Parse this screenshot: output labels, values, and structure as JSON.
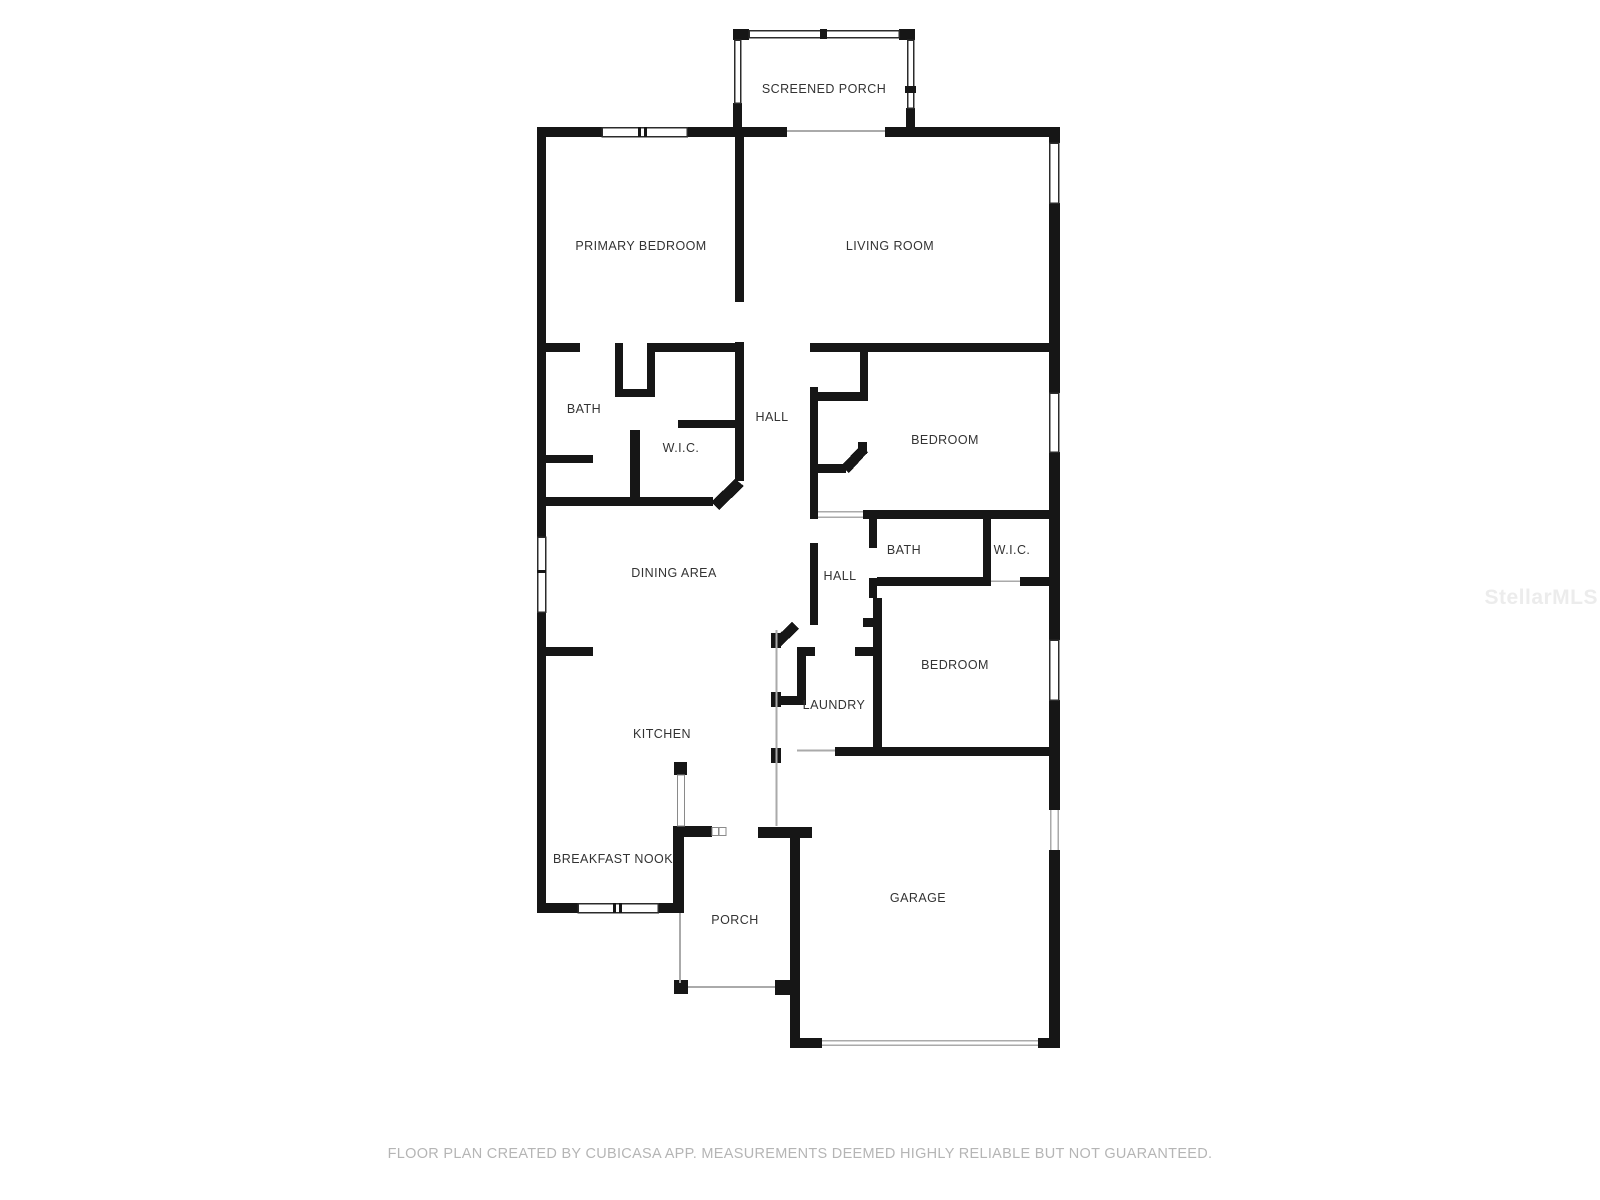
{
  "floor_plan": {
    "rooms": [
      {
        "id": "screened-porch",
        "label": "SCREENED PORCH",
        "x": 824,
        "y": 89
      },
      {
        "id": "primary-bedroom",
        "label": "PRIMARY BEDROOM",
        "x": 641,
        "y": 246
      },
      {
        "id": "living-room",
        "label": "LIVING ROOM",
        "x": 890,
        "y": 246
      },
      {
        "id": "primary-bath",
        "label": "BATH",
        "x": 584,
        "y": 409
      },
      {
        "id": "primary-wic",
        "label": "W.I.C.",
        "x": 681,
        "y": 448
      },
      {
        "id": "hall",
        "label": "HALL",
        "x": 772,
        "y": 417
      },
      {
        "id": "bedroom-2",
        "label": "BEDROOM",
        "x": 945,
        "y": 440
      },
      {
        "id": "dining-area",
        "label": "DINING AREA",
        "x": 674,
        "y": 573
      },
      {
        "id": "hall-2",
        "label": "HALL",
        "x": 840,
        "y": 576
      },
      {
        "id": "bath-2",
        "label": "BATH",
        "x": 904,
        "y": 550
      },
      {
        "id": "wic-2",
        "label": "W.I.C.",
        "x": 1012,
        "y": 550
      },
      {
        "id": "bedroom-3",
        "label": "BEDROOM",
        "x": 955,
        "y": 665
      },
      {
        "id": "laundry",
        "label": "LAUNDRY",
        "x": 834,
        "y": 705
      },
      {
        "id": "kitchen",
        "label": "KITCHEN",
        "x": 662,
        "y": 734
      },
      {
        "id": "breakfast-nook",
        "label": "BREAKFAST NOOK",
        "x": 613,
        "y": 859
      },
      {
        "id": "porch",
        "label": "PORCH",
        "x": 735,
        "y": 920
      },
      {
        "id": "garage",
        "label": "GARAGE",
        "x": 918,
        "y": 898
      }
    ]
  },
  "footer": {
    "text": "FLOOR PLAN CREATED BY CUBICASA APP. MEASUREMENTS DEEMED HIGHLY RELIABLE BUT NOT GUARANTEED."
  },
  "watermark": {
    "text": "StellarMLS"
  },
  "colors": {
    "wall": "#161616",
    "room_label": "#333333",
    "footer_text": "#b5b5b5",
    "watermark": "#ececec"
  }
}
